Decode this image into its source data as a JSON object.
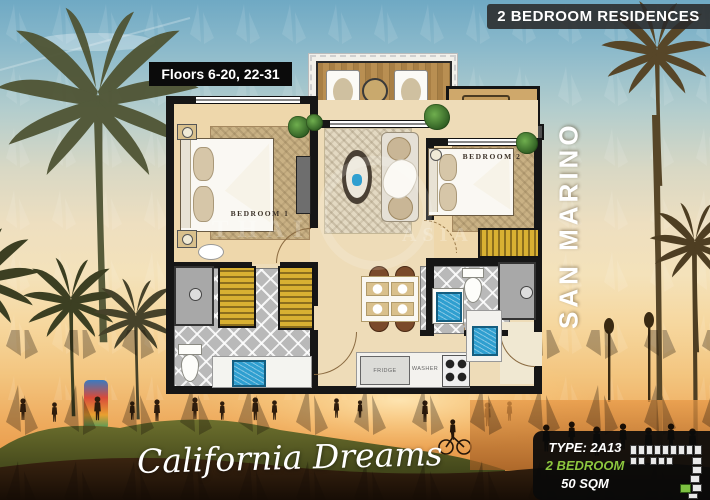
{
  "header": {
    "residences_banner": "2 BEDROOM RESIDENCES",
    "floors_label": "Floors 6-20, 22-31"
  },
  "building": {
    "name": "SAN MARINO"
  },
  "tagline": {
    "text": "California Dreams"
  },
  "plan": {
    "bedroom1_label": "BEDROOM 1",
    "bedroom2_label": "BEDROOM 2",
    "fridge_label": "FRIDGE",
    "washer_label": "WASHER"
  },
  "watermark": {
    "part1": "THAI",
    "part2": "ASIA"
  },
  "unit": {
    "type_label": "TYPE: 2A13",
    "bedrooms_label": "2 BEDROOM",
    "area_label": "50 SQM"
  },
  "colors": {
    "accent_green": "#8cc63e",
    "keyplan_highlight": "#7dc142",
    "banner_bg": "#2a2a2a",
    "wardrobe_gold": "#d8b032",
    "sink_blue": "#2f9fd0"
  }
}
